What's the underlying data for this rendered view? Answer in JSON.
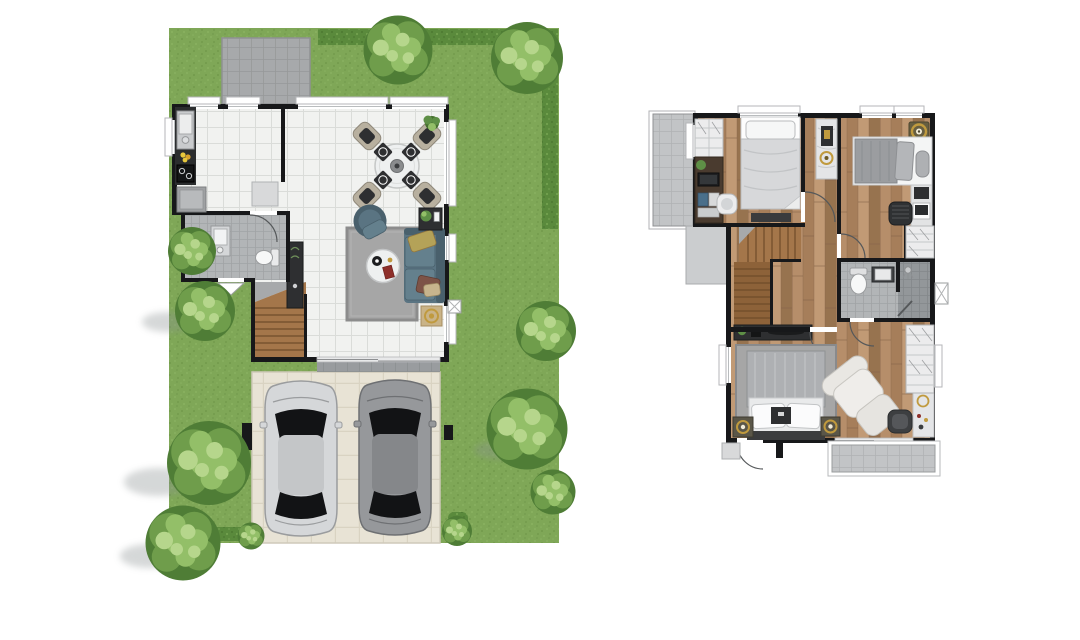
{
  "canvas": {
    "width": 1080,
    "height": 640,
    "background": "#ffffff"
  },
  "palette": {
    "bg": "#ffffff",
    "lawn": "#7fa757",
    "lawnLight": "#92b96a",
    "lawnDark": "#688f43",
    "hedge": "#5a8a3c",
    "hedgeDark": "#47722e",
    "treeDark": "#4f7d36",
    "treeMid": "#6f9d4b",
    "treeLight": "#93bf68",
    "treeHi": "#b6d68c",
    "shadow": "#8a9192",
    "wall": "#17181a",
    "tileBase": "#f1f2f0",
    "tileLine": "#dadcd9",
    "bathTile": "#b2b5b7",
    "bathLine": "#a0a3a5",
    "showerTile": "#93979a",
    "showerLine": "#83878a",
    "woodA": "#b68e6a",
    "woodB": "#a67e5a",
    "woodC": "#c19a75",
    "woodD": "#97734f",
    "woodSeam": "#86644a",
    "stairA": "#a4764a",
    "stairB": "#8d6239",
    "stairLine": "#6f4c2a",
    "drive": "#e8e3d5",
    "driveLine": "#d9d3c2",
    "concrete": "#a7a9ab",
    "concreteLine": "#969899",
    "balcony": "#c2c4c6",
    "balconyLine": "#b0b2b4",
    "roofLedge": "#cbcdcf",
    "white": "#ffffff",
    "offWhite": "#ececed",
    "grayFurn": "#d8d9da",
    "darkFurn": "#2e2f31",
    "counter": "#2b2d2e",
    "fridge": "#9fa1a3",
    "sofa": "#5a7482",
    "sofaDark": "#49606c",
    "sofaLight": "#64808d",
    "cushionOlive": "#b4a258",
    "cushionBrown": "#7d5347",
    "cushionTan": "#c7b48d",
    "rug": "#a6a6a6",
    "rugDark": "#8c8c8c",
    "tableWhite": "#eef0f0",
    "gold": "#c09a3e",
    "red": "#8e2f2a",
    "plant": "#5e8f46",
    "plantDark": "#46702f",
    "carSilver": "#d5d7d9",
    "carSilverRoof": "#c4c6c8",
    "carSilverShade": "#9a9c9e",
    "carDark2": "#96989b",
    "carDarkRoof": "#85878a",
    "carDarkShade": "#6e7073",
    "carWindow": "#121315",
    "duvetLight": "#d7d8da",
    "duvetGray": "#9b9da0",
    "duvetMaster": "#aeb0b3",
    "sheet": "#e9eaeb",
    "headboard": "#3b3c3e",
    "marble": "#e4e5e7",
    "marbleVein": "#c7c9cb",
    "beige": "#c9b387",
    "chairTan": "#b8b09f"
  },
  "plans": {
    "ground_floor": {
      "name": "ground-floor-site-plan",
      "rooms": [
        "garden",
        "patio",
        "kitchen",
        "dining-area",
        "living-area",
        "bathroom",
        "staircase",
        "terrace",
        "driveway"
      ],
      "furniture": [
        "kitchen-counter-with-sink-and-stove",
        "refrigerator",
        "cabinet",
        "dining-table-4-chairs",
        "corner-plant",
        "sofa",
        "armchair",
        "coffee-table",
        "side-table",
        "gold-tray-table",
        "area-rug",
        "toilet",
        "wash-basin",
        "hall-console",
        "air-conditioner-unit",
        "gate-posts"
      ],
      "vehicles": [
        "silver-car",
        "gray-car"
      ],
      "landscape": [
        "hedge-top",
        "hedge-right",
        "trees",
        "bushes"
      ]
    },
    "upper_floor": {
      "name": "upper-floor-plan",
      "rooms": [
        "bedroom-2",
        "bedroom-3",
        "master-bedroom",
        "bathroom",
        "hallway",
        "staircase",
        "front-balcony",
        "lower-roof-ledge",
        "master-balcony"
      ],
      "furniture": [
        "wardrobe",
        "desk-with-laptop",
        "desk-chair",
        "single-bed",
        "foot-bench",
        "marble-console",
        "ceiling-lamp-gold",
        "bed-with-bolster",
        "study-desk",
        "walk-in-closet",
        "toilet",
        "wash-basin",
        "shower",
        "stair-console",
        "double-bed",
        "nightstand-lamps",
        "lounge-chair-with-ottoman",
        "vanity-stool",
        "vanity-table",
        "master-wardrobe"
      ]
    }
  }
}
